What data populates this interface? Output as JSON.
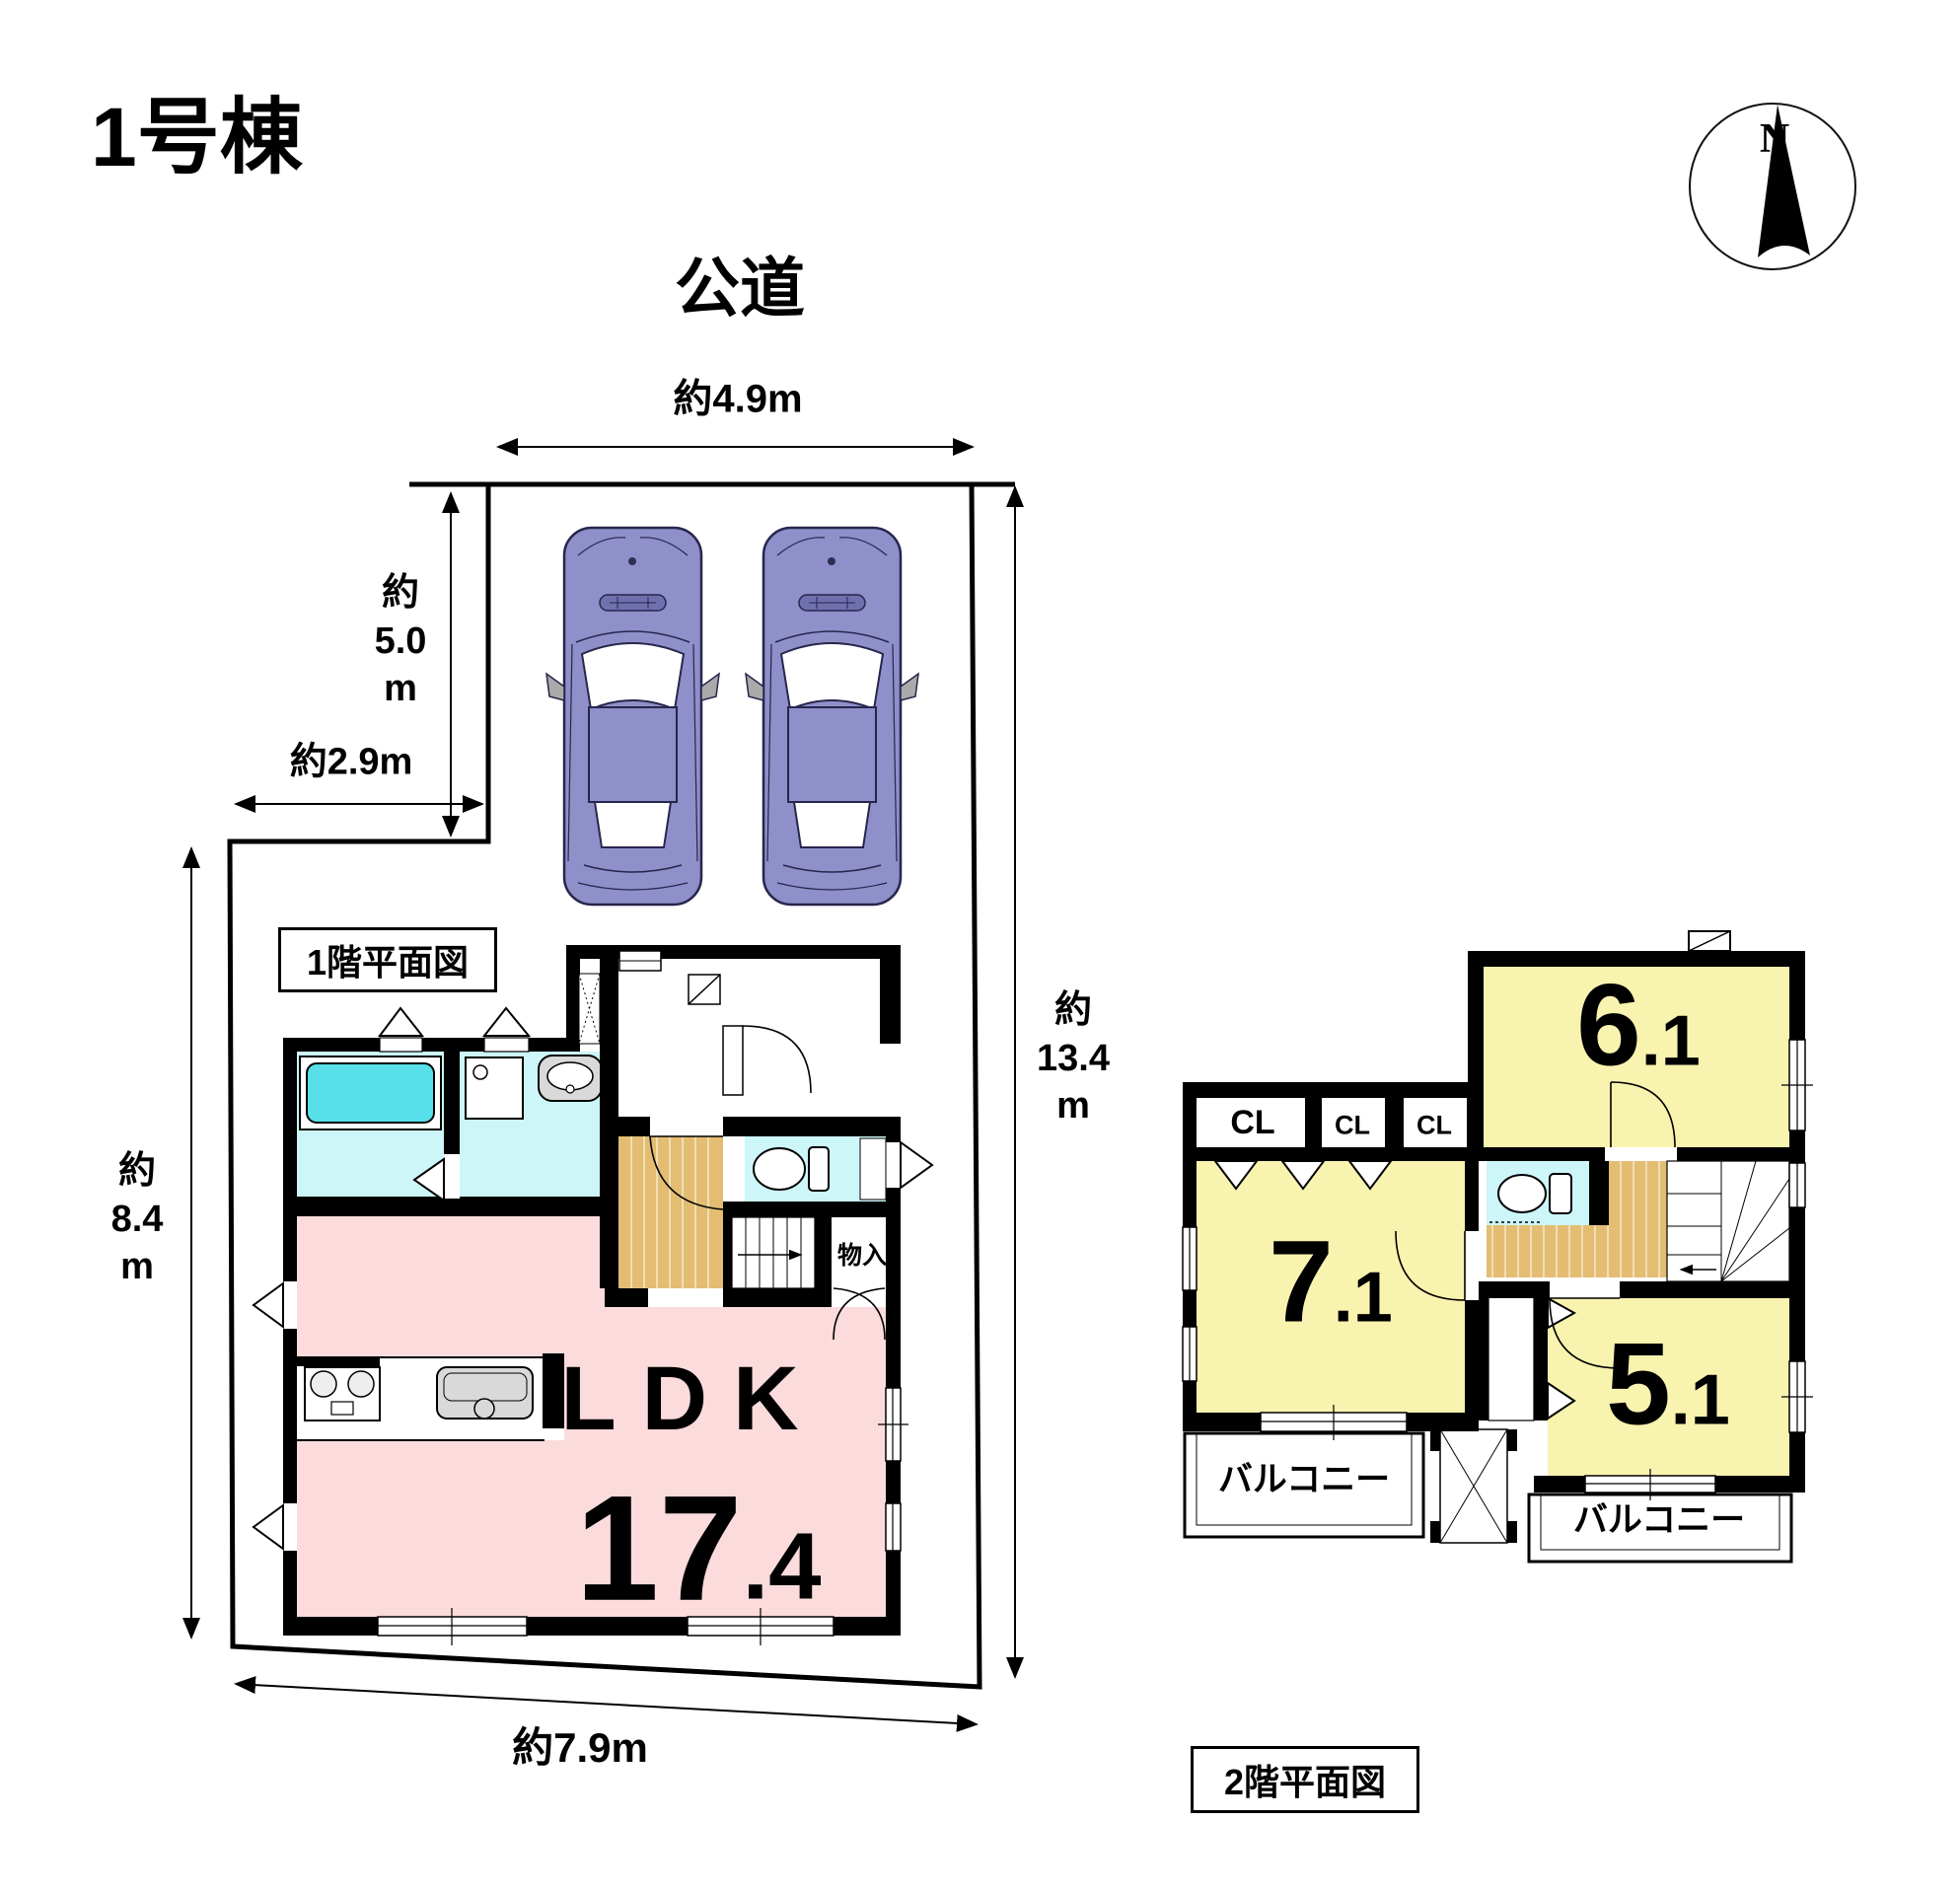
{
  "title": "1号棟",
  "site": {
    "road_label": "公道",
    "dim_frontage": "約4.9m",
    "dim_parking_depth": "約\n5.0\nm",
    "dim_setback": "約2.9m",
    "dim_left_side": "約\n8.4\nm",
    "dim_right_side": "約\n13.4\nm",
    "dim_bottom": "約7.9m"
  },
  "compass": {
    "north": "N"
  },
  "floor1": {
    "caption": "1階平面図",
    "ldk_label": "LDK",
    "ldk_area_int": "17",
    "ldk_area_dec": ".4",
    "storage_label": "物入"
  },
  "floor2": {
    "caption": "2階平面図",
    "closet1": "CL",
    "closet2": "CL",
    "closet3": "CL",
    "room6_int": "6",
    "room6_dec": ".1",
    "room7_int": "7",
    "room7_dec": ".1",
    "room5_int": "5",
    "room5_dec": ".1",
    "balcony_left": "バルコニー",
    "balcony_right": "バルコニー"
  },
  "colors": {
    "wall": "#000000",
    "ldk_pink": "#fbdbdb",
    "room_yellow": "#f9f3b0",
    "wet_area_cyan": "#cdf6f8",
    "bathtub_cyan": "#57e0e9",
    "wood_tan": "#e3bd72",
    "fixture_gray": "#d9d9d9",
    "car_purple": "#8f8fc9"
  }
}
